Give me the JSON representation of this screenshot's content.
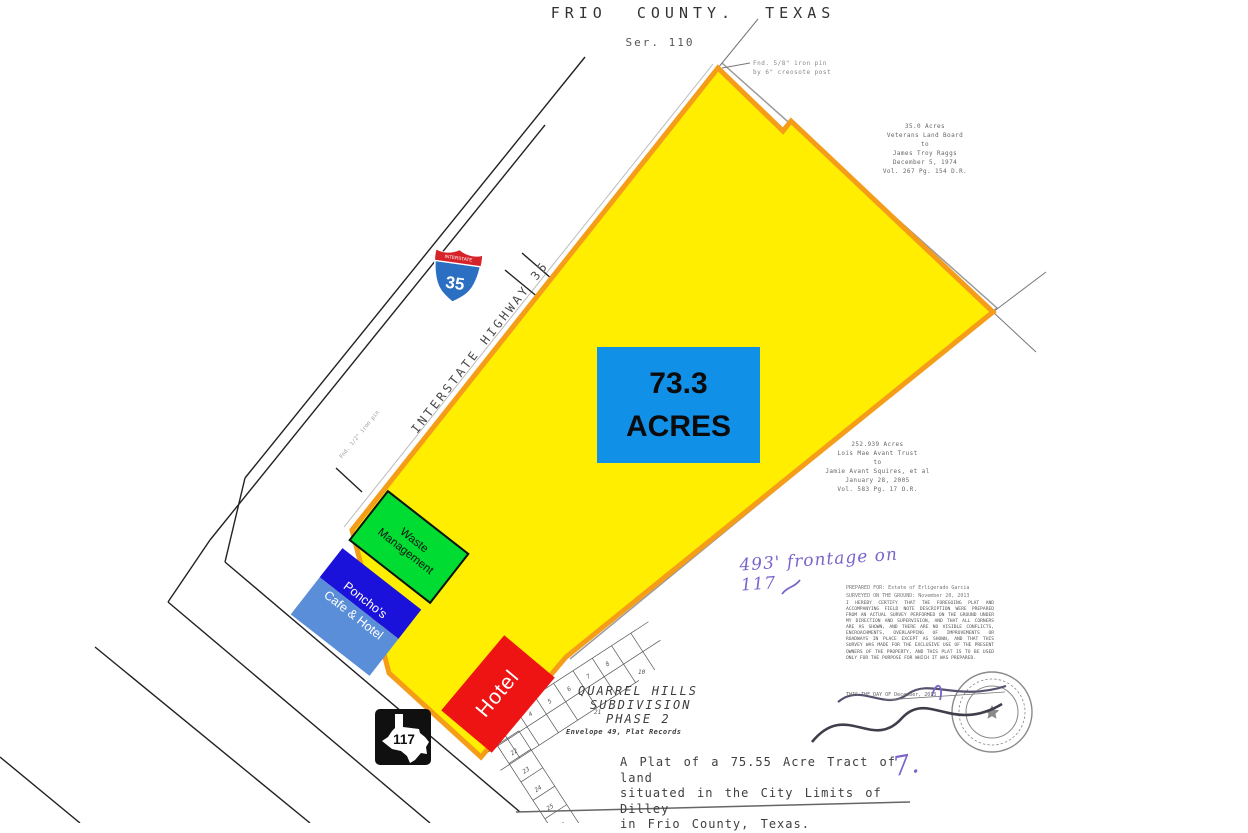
{
  "header": {
    "title": "FRIO COUNTY. TEXAS",
    "series": "Ser. 110"
  },
  "parcel": {
    "acres_value": "73.3",
    "acres_unit": "ACRES"
  },
  "overlays": {
    "waste": {
      "line1": "Waste",
      "line2": "Management"
    },
    "ponchos": {
      "line1": "Poncho's",
      "line2": "Cafe & Hotel"
    },
    "hotel": {
      "label": "Hotel"
    }
  },
  "highway": {
    "label": "INTERSTATE HIGHWAY 35",
    "shield_top": "INTERSTATE",
    "shield_number": "35"
  },
  "farm_road": {
    "top": "FARM",
    "number": "117",
    "bottom": "ROAD"
  },
  "notes": {
    "corner_pin_line1": "Fnd. 5/8\" iron pin",
    "corner_pin_line2": "by 6\" creosote post",
    "side_pin": "Fnd. 1/2\" iron pin"
  },
  "deeds": {
    "upper": [
      "35.0 Acres",
      "Veterans Land Board",
      "to",
      "James Troy Raggs",
      "December 5, 1974",
      "Vol. 267 Pg. 154 D.R."
    ],
    "right": [
      "252.939 Acres",
      "Lois Mae Avant Trust",
      "to",
      "Jamie Avant Squires, et al",
      "January 28, 2005",
      "Vol. 583 Pg. 17 O.R."
    ]
  },
  "handwriting": {
    "frontage": "493' frontage on 117",
    "mark": "7."
  },
  "prepared": {
    "line1": "PREPARED FOR:  Estate of Erligerado Garcia",
    "line2": "SURVEYED ON THE GROUND:  November 20, 2013"
  },
  "certification": {
    "text": "I HEREBY CERTIFY THAT THE FOREGOING PLAT AND ACCOMPANYING FIELD NOTE DESCRIPTION WERE PREPARED FROM AN ACTUAL SURVEY PERFORMED ON THE GROUND UNDER MY DIRECTION AND SUPERVISION, AND THAT ALL CORNERS ARE AS SHOWN, AND THERE ARE NO VISIBLE CONFLICTS, ENCROACHMENTS, OVERLAPPING OF IMPROVEMENTS OR ROADWAYS IN PLACE EXCEPT AS SHOWN, AND THAT THIS SURVEY WAS MADE FOR THE EXCLUSIVE USE OF THE PRESENT OWNERS OF THE PROPERTY, AND THIS PLAT IS TO BE USED ONLY FOR THE PURPOSE FOR WHICH IT WAS PREPARED.",
    "dated": "THIS THE        DAY OF  December,  2013"
  },
  "subdivision": {
    "name1": "QUARREL HILLS",
    "name2": "SUBDIVISION",
    "name3": "PHASE 2",
    "record": "Envelope 49, Plat Records",
    "lots": [
      "3",
      "4",
      "5",
      "6",
      "7",
      "8",
      "10",
      "21",
      "22",
      "23",
      "24",
      "25",
      "26",
      "30"
    ]
  },
  "statement": {
    "line1": "A Plat of a 75.55 Acre Tract of land",
    "line2": "situated in the City Limits of Dilley",
    "line3": "in Frio County, Texas."
  },
  "colors": {
    "parcel_fill": "#FFEE00",
    "parcel_border": "#F59D18",
    "acres_box": "#1190E8",
    "waste_green": "#00DC32",
    "ponchos_dark_blue": "#1A12DB",
    "ponchos_light_blue": "#5B8ED8",
    "hotel_red": "#EE1414",
    "handwriting_purple": "#7B63CC"
  }
}
